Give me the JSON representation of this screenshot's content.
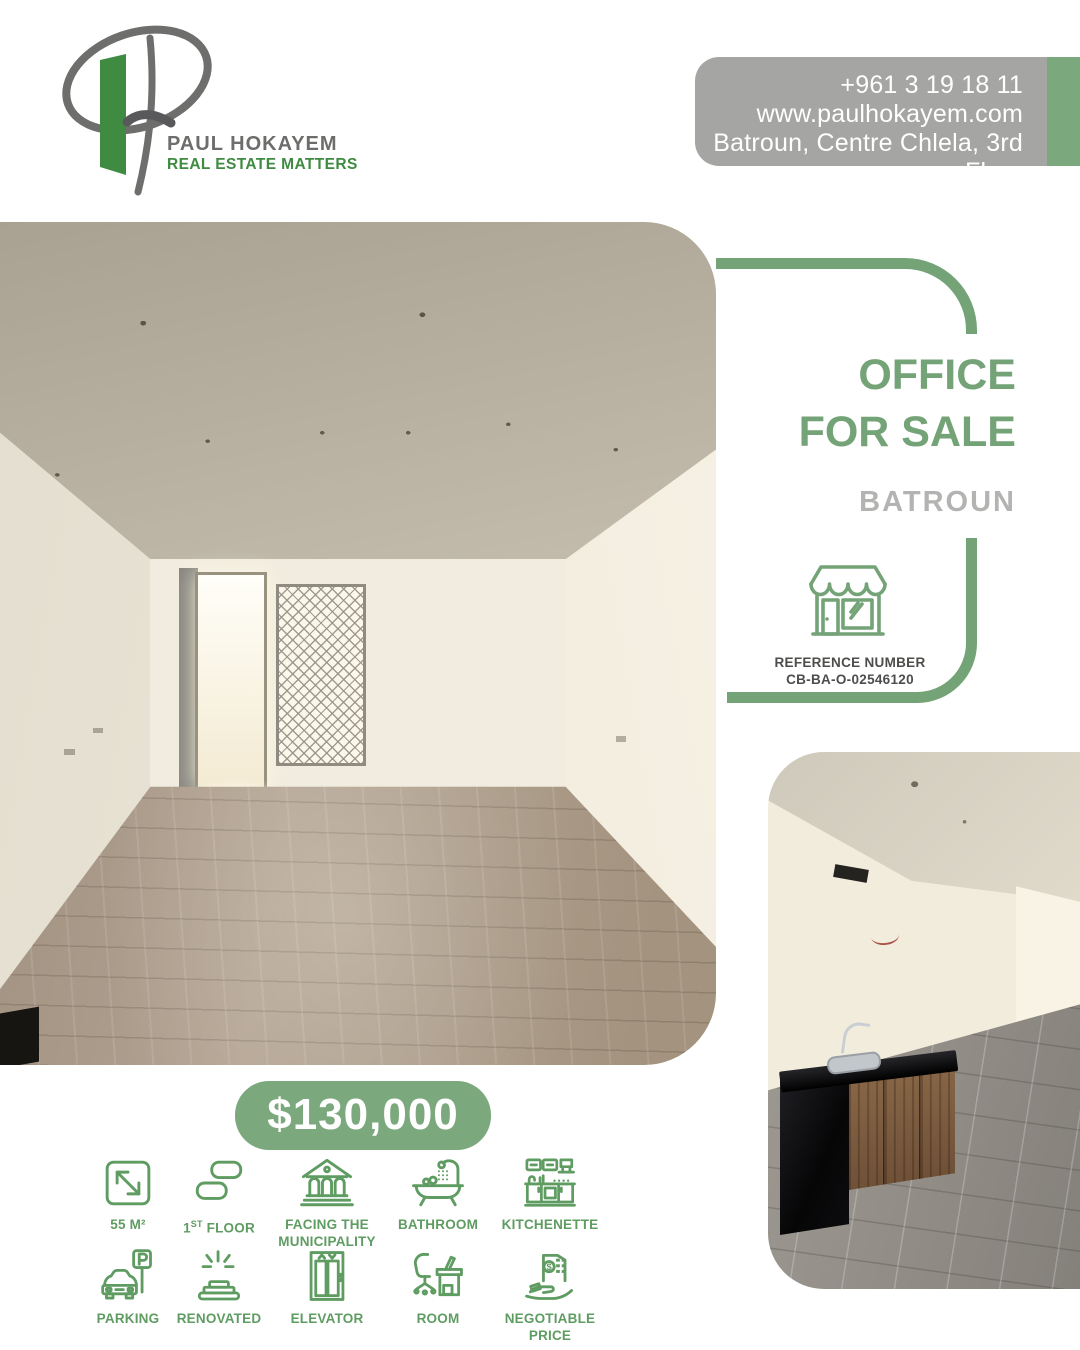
{
  "brand": {
    "name": "PAUL HOKAYEM",
    "tagline": "REAL ESTATE MATTERS"
  },
  "contact": {
    "phone": "+961 3 19 18 11",
    "website": "www.paulhokayem.com",
    "address": "Batroun, Centre Chlela, 3rd Floor"
  },
  "listing": {
    "title_line1": "OFFICE",
    "title_line2": "FOR SALE",
    "location": "BATROUN",
    "reference_label": "REFERENCE NUMBER",
    "reference_number": "CB-BA-O-02546120",
    "price": "$130,000"
  },
  "features": {
    "items": [
      {
        "label1": "55 M²",
        "label2": ""
      },
      {
        "prefix": "1",
        "sup": "ST",
        "rest": " FLOOR",
        "label2": ""
      },
      {
        "label1": "FACING THE",
        "label2": "MUNICIPALITY"
      },
      {
        "label1": "BATHROOM",
        "label2": ""
      },
      {
        "label1": "KITCHENETTE",
        "label2": ""
      },
      {
        "label1": "PARKING",
        "label2": ""
      },
      {
        "label1": "RENOVATED",
        "label2": ""
      },
      {
        "label1": "ELEVATOR",
        "label2": ""
      },
      {
        "label1": "ROOM",
        "label2": ""
      },
      {
        "label1": "NEGOTIABLE",
        "label2": "PRICE"
      }
    ]
  },
  "colors": {
    "accent_green": "#73a377",
    "badge_green": "#7ba87c",
    "icon_green": "#5f9c62",
    "logo_green": "#3e8b41",
    "brand_gray": "#6d6d6b",
    "contact_gray": "#a5a5a3",
    "location_gray": "#b3b3b1",
    "dark_text": "#4d4d4b"
  }
}
